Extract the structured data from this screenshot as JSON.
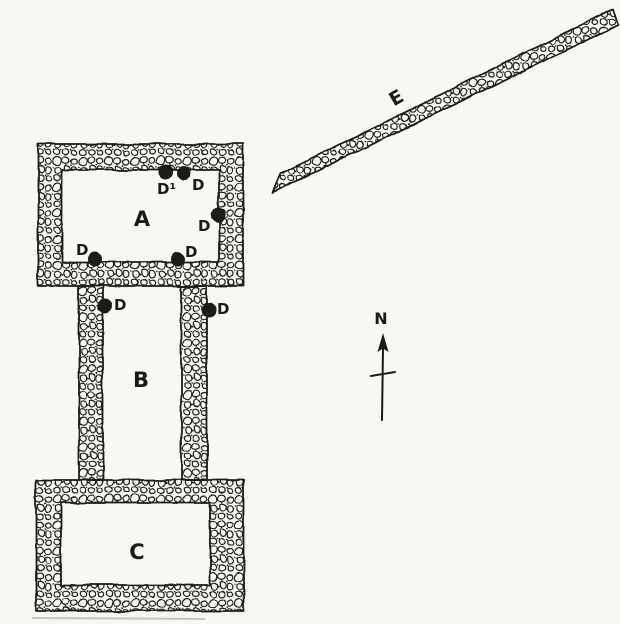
{
  "figure_type": "archaeological-site-plan",
  "colors": {
    "paper": "#f8f7f4",
    "ink": "#1b1a17"
  },
  "plan": {
    "rooms": [
      {
        "id": "A",
        "label": "A"
      },
      {
        "id": "B",
        "label": "B"
      },
      {
        "id": "C",
        "label": "C"
      }
    ],
    "wall_e": {
      "label": "E"
    },
    "north": {
      "label": "N"
    },
    "post_holes": [
      {
        "label": "D¹"
      },
      {
        "label": "D"
      },
      {
        "label": "D"
      },
      {
        "label": "D"
      },
      {
        "label": "D"
      },
      {
        "label": "D"
      },
      {
        "label": "D"
      }
    ]
  }
}
